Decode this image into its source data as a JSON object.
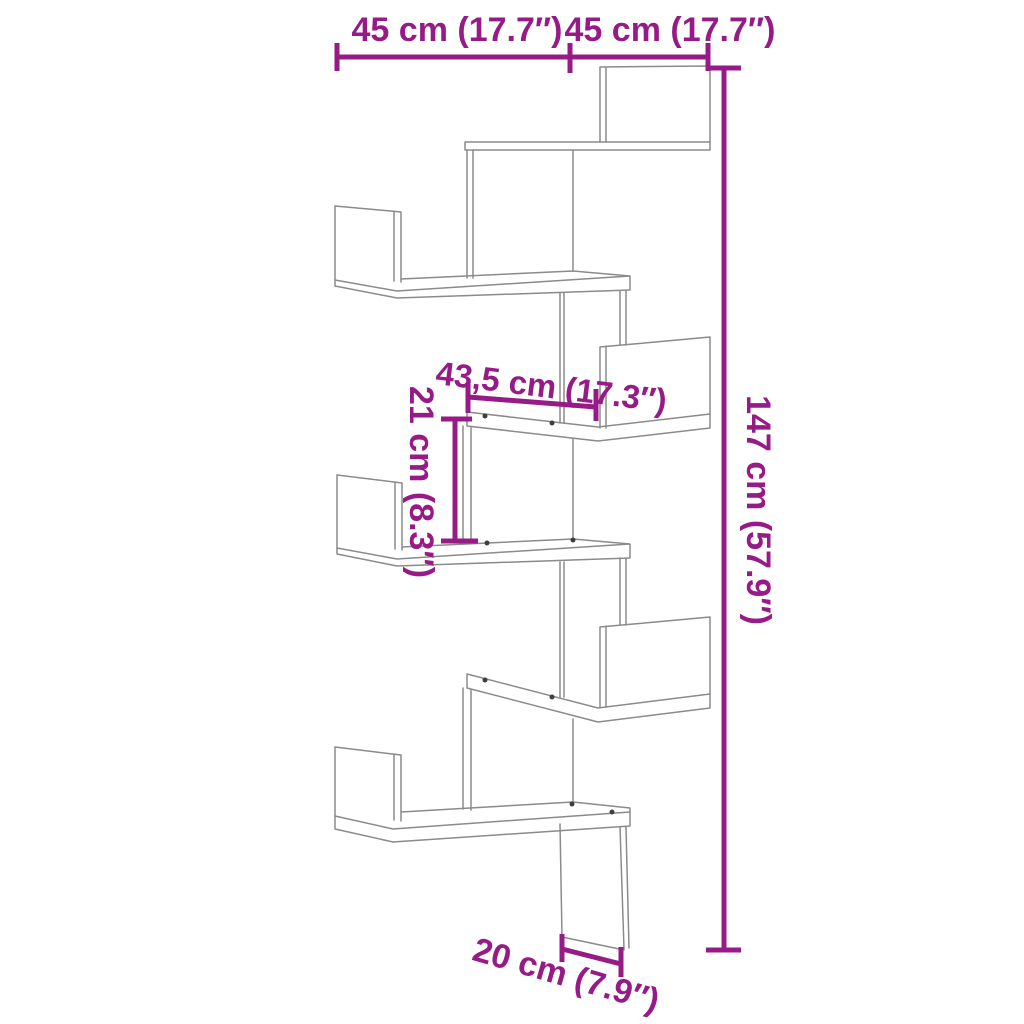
{
  "colors": {
    "dimension_accent": "#971b87",
    "drawing_line": "#8b8b8b",
    "background": "#ffffff"
  },
  "diagram": {
    "type": "product-dimension-line-drawing",
    "subject": "corner wall shelf with zigzag boards",
    "labels": {
      "width_left": "45 cm (17.7″)",
      "width_right": "45 cm (17.7″)",
      "height_total": "147 cm (57.9″)",
      "shelf_depth": "43,5 cm (17.3″)",
      "gap_height": "21 cm (8.3″)",
      "bottom_depth": "20 cm (7.9″)"
    }
  }
}
